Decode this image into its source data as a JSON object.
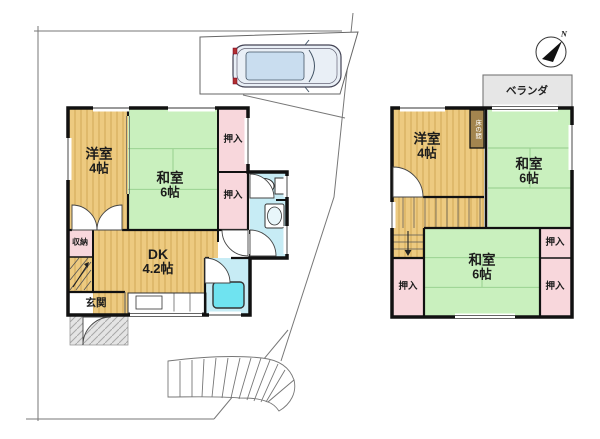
{
  "compass": {
    "north_label": "N"
  },
  "floor1": {
    "western_room": {
      "name": "洋室",
      "size": "4帖"
    },
    "japanese_room": {
      "name": "和室",
      "size": "6帖"
    },
    "dk": {
      "name": "DK",
      "size": "4.2帖"
    },
    "closet_top": {
      "label": "押入"
    },
    "closet_bottom": {
      "label": "押入"
    },
    "storage": {
      "label": "収納"
    },
    "entrance": {
      "label": "玄関"
    }
  },
  "floor2": {
    "western_room": {
      "name": "洋室",
      "size": "4帖"
    },
    "japanese_room_upper": {
      "name": "和室",
      "size": "6帖"
    },
    "japanese_room_lower": {
      "name": "和室",
      "size": "6帖"
    },
    "closet_left": {
      "label": "押入"
    },
    "closet_right_top": {
      "label": "押入"
    },
    "closet_right_bottom": {
      "label": "押入"
    },
    "veranda": {
      "label": "ベランダ"
    },
    "tokonoma": {
      "label": "床の間"
    }
  },
  "colors": {
    "wood_floor": "#EDCA80",
    "wood_stripe": "#D9B262",
    "tatami_green": "#C9F0BE",
    "tatami_line": "#93CD8A",
    "closet_pink": "#F8D7DC",
    "wet_area_cyan": "#C7ECF5",
    "bathtub_cyan": "#6FE3F0",
    "veranda_gray": "#E6E6E6",
    "wall_black": "#111111",
    "boundary_gray": "#777777",
    "car_body_blue": "#C9DDEF"
  }
}
